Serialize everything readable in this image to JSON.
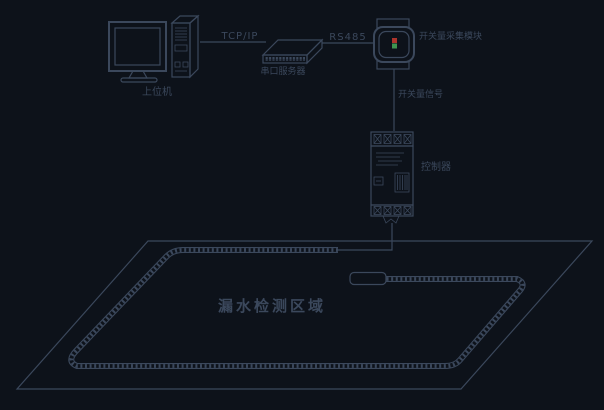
{
  "diagram": {
    "kind": "water-leak-detection-system-topology",
    "background_color": "#0d121a",
    "line_color": "#3b485c",
    "labels": {
      "host_computer": "上位机",
      "tcp_ip_link": "TCP/IP",
      "serial_server": "串口服务器",
      "rs485_link": "RS485",
      "io_module": "开关量采集模块",
      "switch_signal": "开关量信号",
      "controller": "控制器",
      "detection_area": "漏水检测区域"
    },
    "indicators": {
      "module_led_red": "#ad342c",
      "module_led_green": "#3f9450"
    }
  }
}
